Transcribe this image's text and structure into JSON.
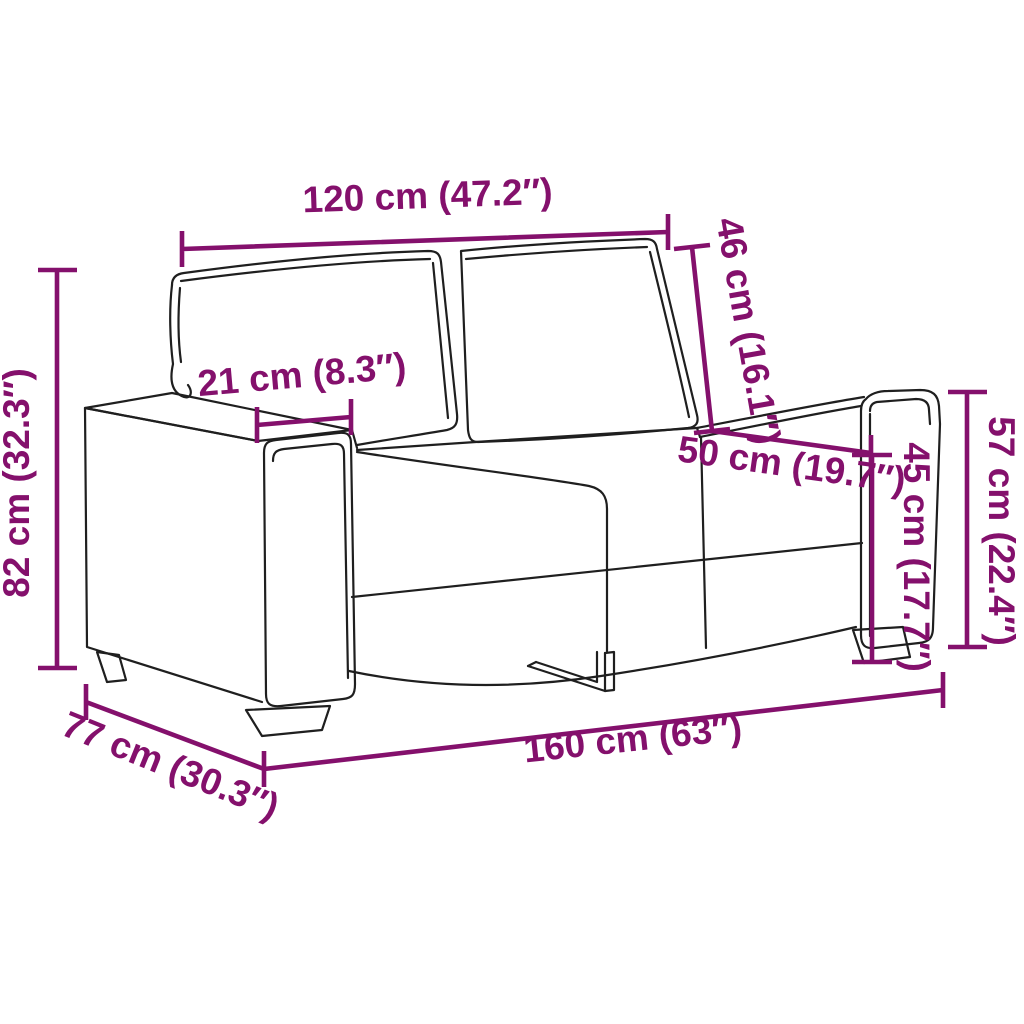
{
  "diagram": {
    "title": "2-seater sofa dimension diagram",
    "style": {
      "dimension_color": "#84106C",
      "artwork_line_color": "#1f1f1f",
      "background_color": "#ffffff"
    },
    "dimensions": [
      {
        "id": "back-width",
        "label": "120 cm (47.2″)",
        "value_cm": 120,
        "value_inch": 47.2
      },
      {
        "id": "back-cushion-height",
        "label": "46 cm (16.1″)",
        "value_cm": 46,
        "value_inch": 16.1
      },
      {
        "id": "armrest-width",
        "label": "21 cm (8.3″)",
        "value_cm": 21,
        "value_inch": 8.3
      },
      {
        "id": "seat-depth",
        "label": "50 cm (19.7″)",
        "value_cm": 50,
        "value_inch": 19.7
      },
      {
        "id": "seat-height",
        "label": "45 cm (17.7″)",
        "value_cm": 45,
        "value_inch": 17.7
      },
      {
        "id": "armrest-height",
        "label": "57 cm (22.4″)",
        "value_cm": 57,
        "value_inch": 22.4
      },
      {
        "id": "total-height",
        "label": "82 cm (32.3″)",
        "value_cm": 82,
        "value_inch": 32.3
      },
      {
        "id": "total-depth",
        "label": "77 cm (30.3″)",
        "value_cm": 77,
        "value_inch": 30.3
      },
      {
        "id": "total-width",
        "label": "160 cm (63″)",
        "value_cm": 160,
        "value_inch": 63
      }
    ]
  }
}
